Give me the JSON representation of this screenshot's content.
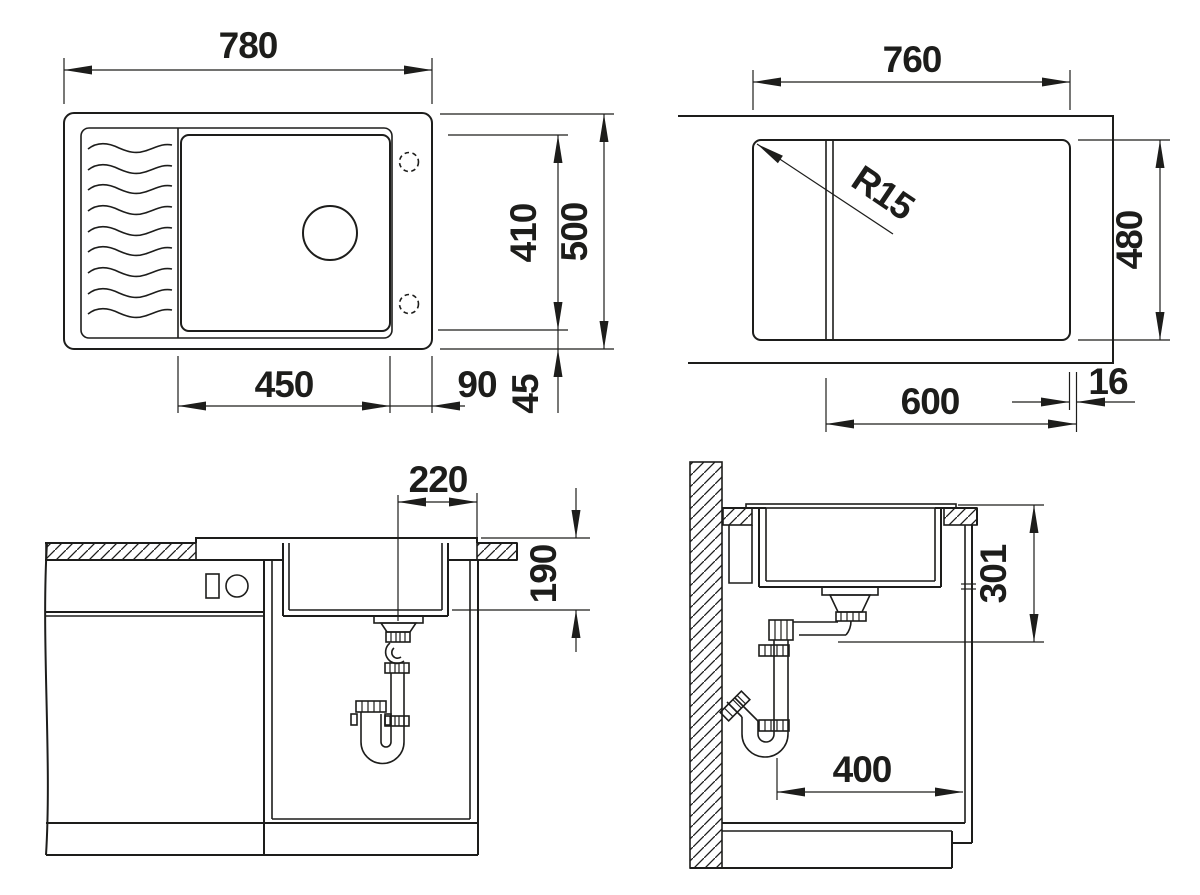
{
  "drawing": {
    "type": "sink-installation-technical-drawing",
    "line_color": "#1d1d1b",
    "background": "#ffffff",
    "dims": {
      "top_sink": {
        "overall_width": "780",
        "overall_depth": "500",
        "bowl_width": "450",
        "bowl_depth": "410",
        "right_gap": "90",
        "bottom_gap": "45"
      },
      "cutout": {
        "width": "760",
        "depth": "480",
        "ledge": "600",
        "edge": "16",
        "radius": "R15"
      },
      "front": {
        "drain_offset": "220",
        "bowl_height": "190"
      },
      "side": {
        "rim_to_outlet": "301",
        "clearance": "400"
      }
    }
  }
}
